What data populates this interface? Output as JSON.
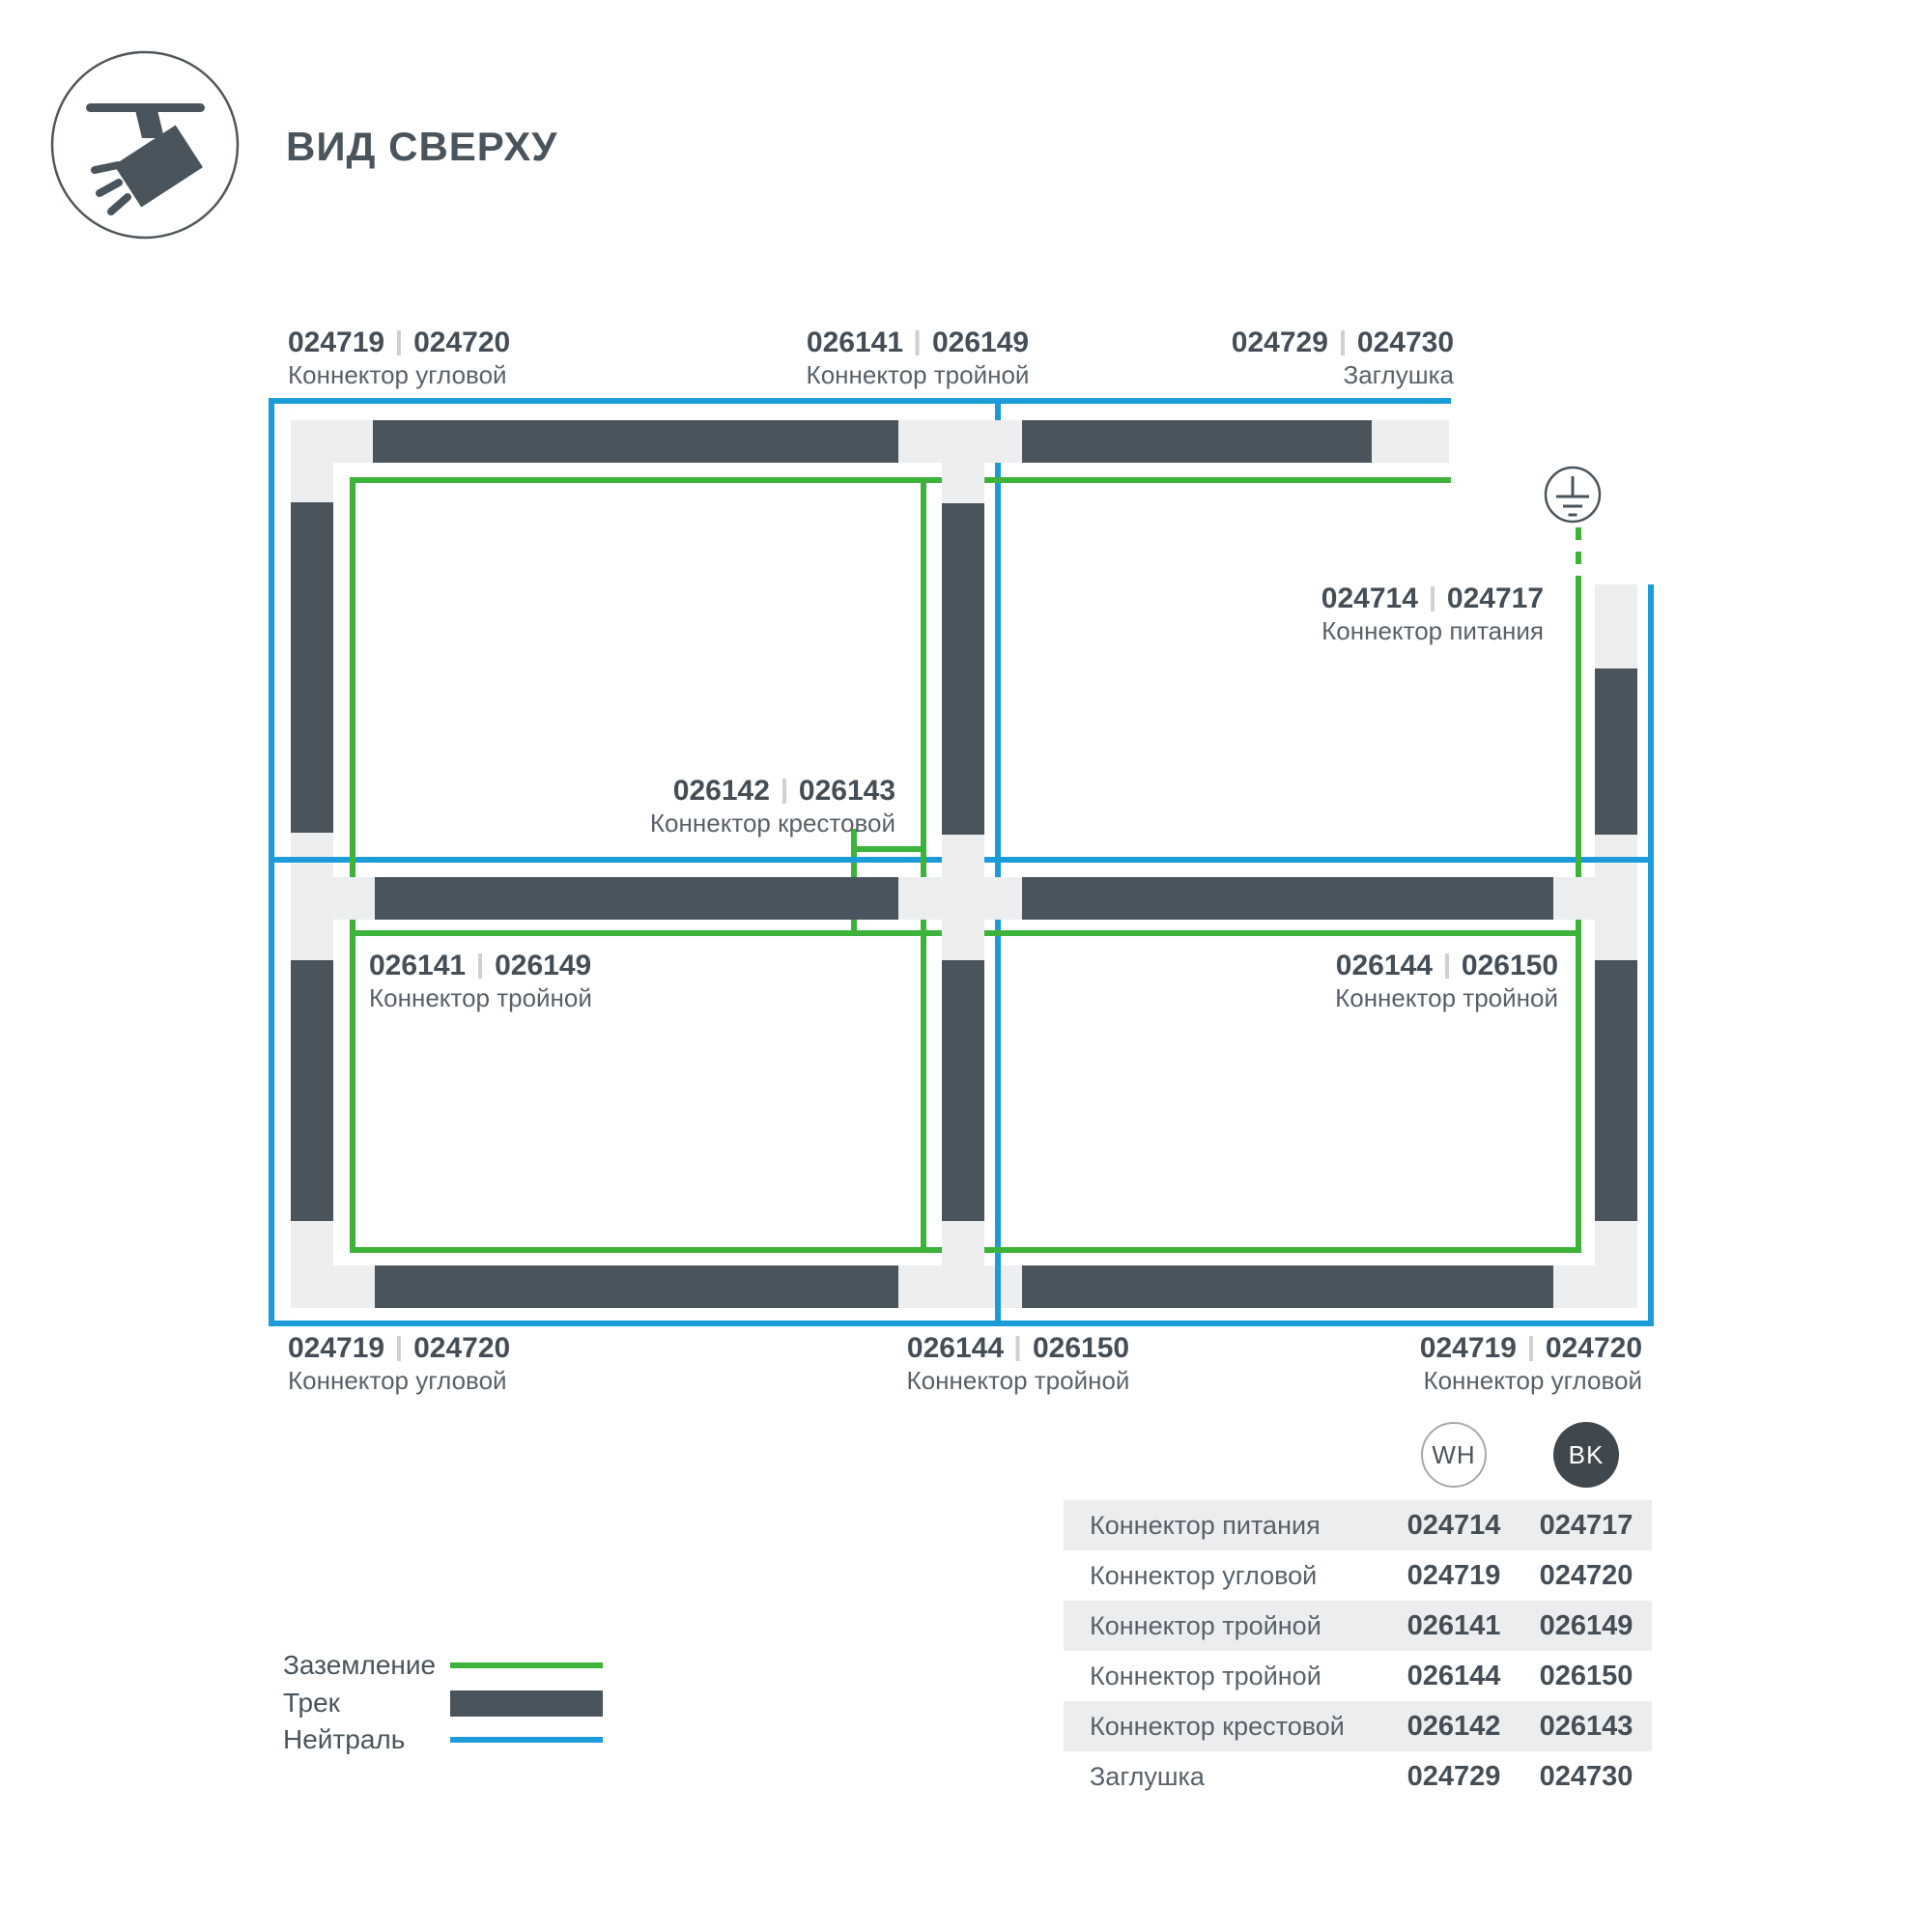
{
  "header": {
    "title": "ВИД СВЕРХУ"
  },
  "colors": {
    "ground_green": "#3db33c",
    "neutral_blue": "#1b9cd8",
    "track_dark": "#4a545c",
    "connector_light": "#eceeef",
    "table_band": "#ebedee",
    "bk_badge": "#40484e"
  },
  "icons": {
    "header_icon": "track-spotlight-icon",
    "earth_icon": "ground-earth-icon"
  },
  "diagram": {
    "labels": [
      {
        "code_a": "024719",
        "code_b": "024720",
        "name": "Коннектор угловой"
      },
      {
        "code_a": "026141",
        "code_b": "026149",
        "name": "Коннектор тройной"
      },
      {
        "code_a": "024729",
        "code_b": "024730",
        "name": "Заглушка"
      },
      {
        "code_a": "024714",
        "code_b": "024717",
        "name": "Коннектор питания"
      },
      {
        "code_a": "026142",
        "code_b": "026143",
        "name": "Коннектор крестовой"
      },
      {
        "code_a": "026141",
        "code_b": "026149",
        "name": "Коннектор тройной"
      },
      {
        "code_a": "026144",
        "code_b": "026150",
        "name": "Коннектор тройной"
      },
      {
        "code_a": "024719",
        "code_b": "024720",
        "name": "Коннектор угловой"
      },
      {
        "code_a": "026144",
        "code_b": "026150",
        "name": "Коннектор тройной"
      },
      {
        "code_a": "024719",
        "code_b": "024720",
        "name": "Коннектор угловой"
      }
    ]
  },
  "legend": {
    "items": [
      {
        "label": "Заземление"
      },
      {
        "label": "Трек"
      },
      {
        "label": "Нейтраль"
      }
    ]
  },
  "table": {
    "col_wh": "WH",
    "col_bk": "BK",
    "rows": [
      {
        "label": "Коннектор питания",
        "wh": "024714",
        "bk": "024717"
      },
      {
        "label": "Коннектор угловой",
        "wh": "024719",
        "bk": "024720"
      },
      {
        "label": "Коннектор тройной",
        "wh": "026141",
        "bk": "026149"
      },
      {
        "label": "Коннектор тройной",
        "wh": "026144",
        "bk": "026150"
      },
      {
        "label": "Коннектор крестовой",
        "wh": "026142",
        "bk": "026143"
      },
      {
        "label": "Заглушка",
        "wh": "024729",
        "bk": "024730"
      }
    ]
  }
}
